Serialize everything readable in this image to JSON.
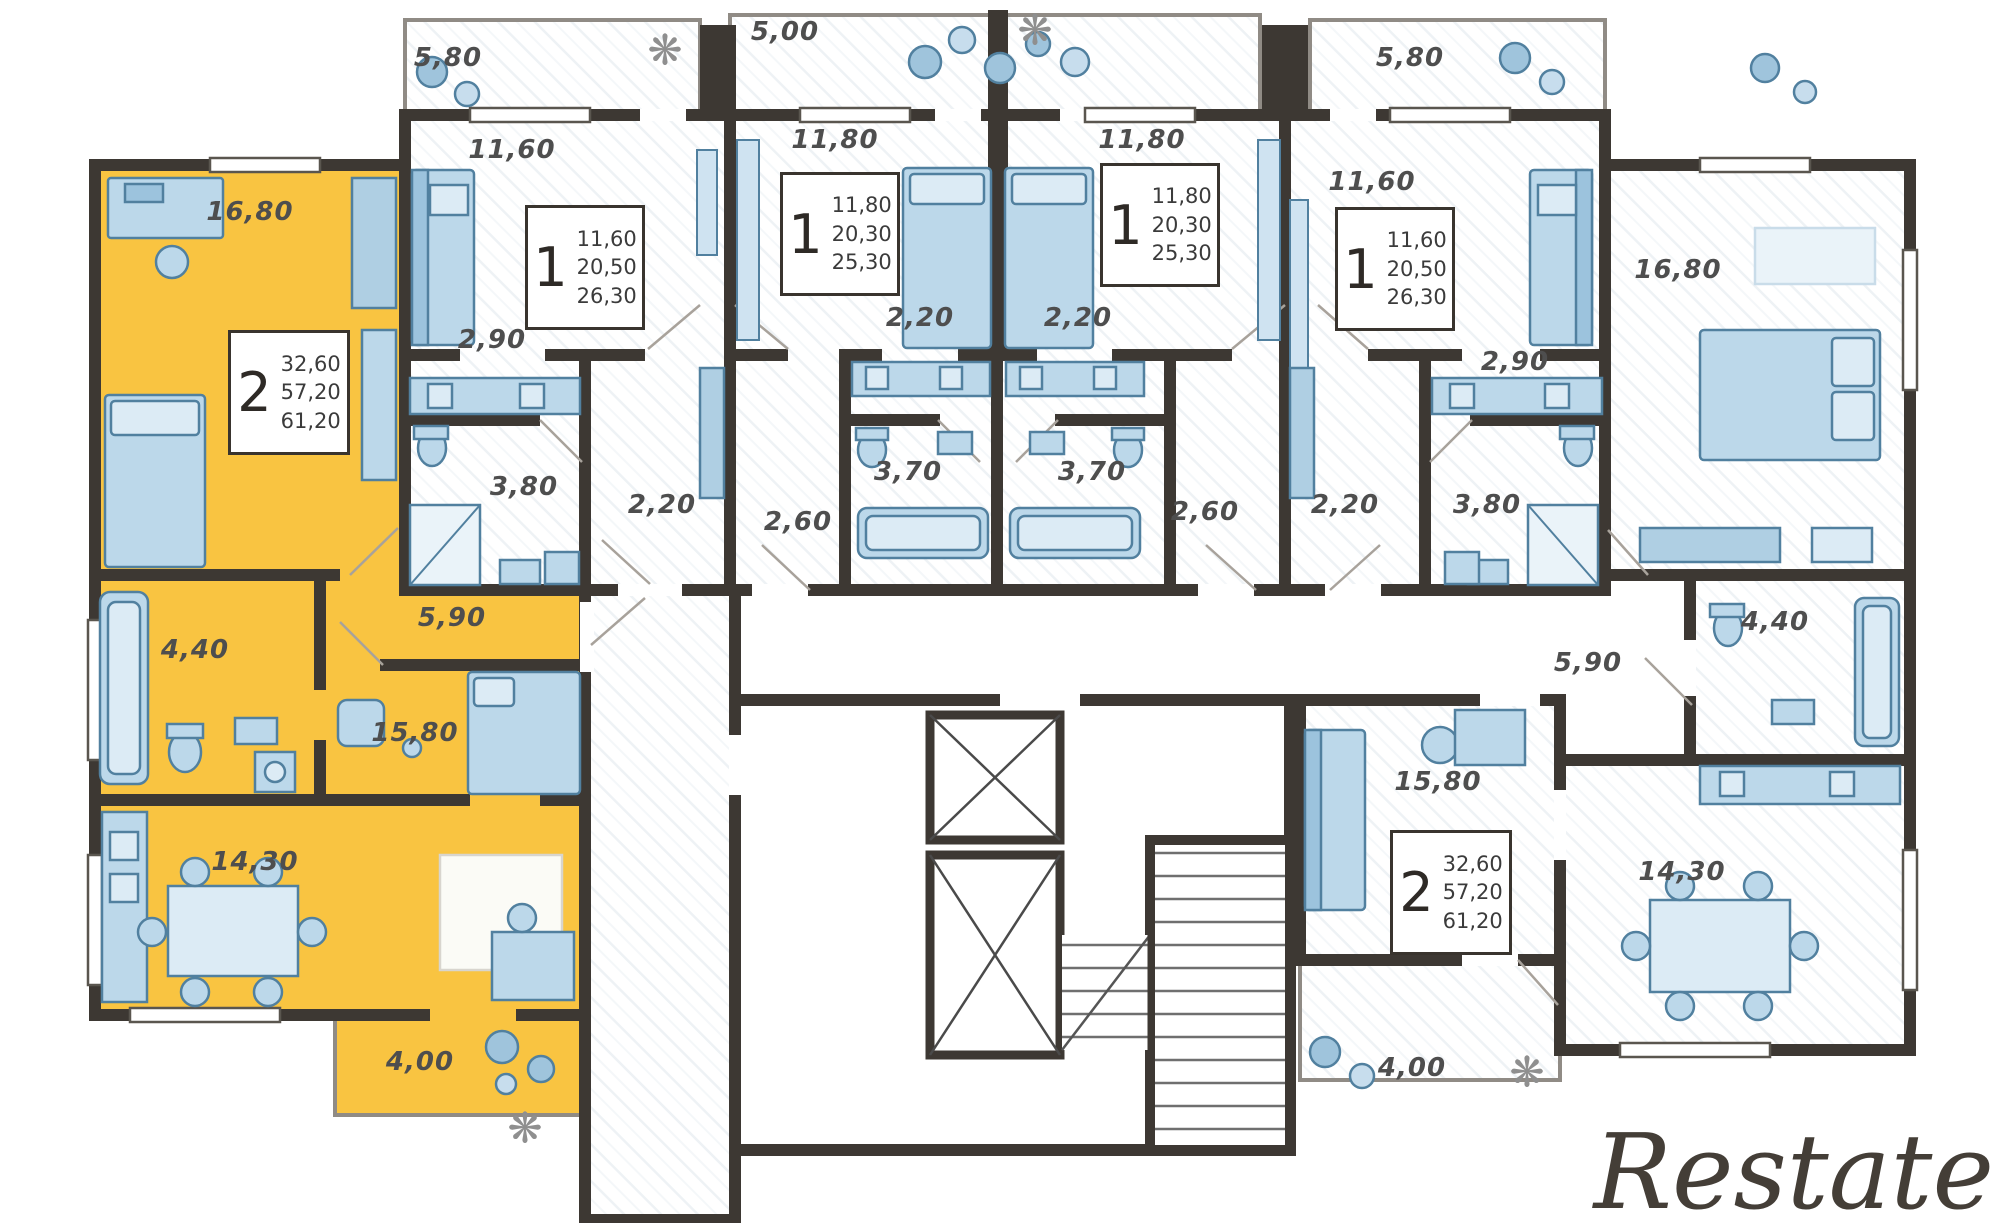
{
  "watermark": "Restate",
  "icons": {
    "plant": "❋"
  },
  "colors": {
    "highlight": "#F9C441",
    "wall": "#3D3833",
    "furniture_fill": "#BCD8EA",
    "furniture_stroke": "#51809F",
    "label": "#4E4E4E"
  },
  "apartments": [
    {
      "name": "two-room-left-highlighted",
      "type": "2",
      "areas": [
        "32,60",
        "57,20",
        "61,20"
      ],
      "rooms": {
        "bedroom": "16,80",
        "bathroom": "4,40",
        "hall": "5,90",
        "bedroom2": "15,80",
        "kitchen_living": "14,30",
        "balcony": "4,00"
      }
    },
    {
      "name": "one-room-a",
      "type": "1",
      "areas": [
        "11,60",
        "20,50",
        "26,30"
      ],
      "rooms": {
        "balcony": "5,80",
        "room": "11,60",
        "kitchen": "2,90",
        "bathroom": "3,80",
        "hall": "2,20"
      }
    },
    {
      "name": "one-room-b",
      "type": "1",
      "areas": [
        "11,80",
        "20,30",
        "25,30"
      ],
      "rooms": {
        "balcony": "5,00",
        "room": "11,80",
        "kitchen": "2,20",
        "bathroom": "3,70",
        "hall": "2,60"
      }
    },
    {
      "name": "one-room-c",
      "type": "1",
      "areas": [
        "11,80",
        "20,30",
        "25,30"
      ],
      "rooms": {
        "room": "11,80",
        "kitchen": "2,20",
        "bathroom": "3,70",
        "hall": "2,60"
      }
    },
    {
      "name": "one-room-d",
      "type": "1",
      "areas": [
        "11,60",
        "20,50",
        "26,30"
      ],
      "rooms": {
        "balcony": "5,80",
        "room": "11,60",
        "kitchen": "2,90",
        "bathroom": "3,80",
        "hall": "2,20"
      }
    },
    {
      "name": "two-room-right",
      "type": "2",
      "areas": [
        "32,60",
        "57,20",
        "61,20"
      ],
      "rooms": {
        "bedroom": "16,80",
        "bathroom": "4,40",
        "hall": "5,90",
        "bedroom2": "15,80",
        "kitchen_living": "14,30",
        "balcony": "4,00"
      }
    }
  ]
}
